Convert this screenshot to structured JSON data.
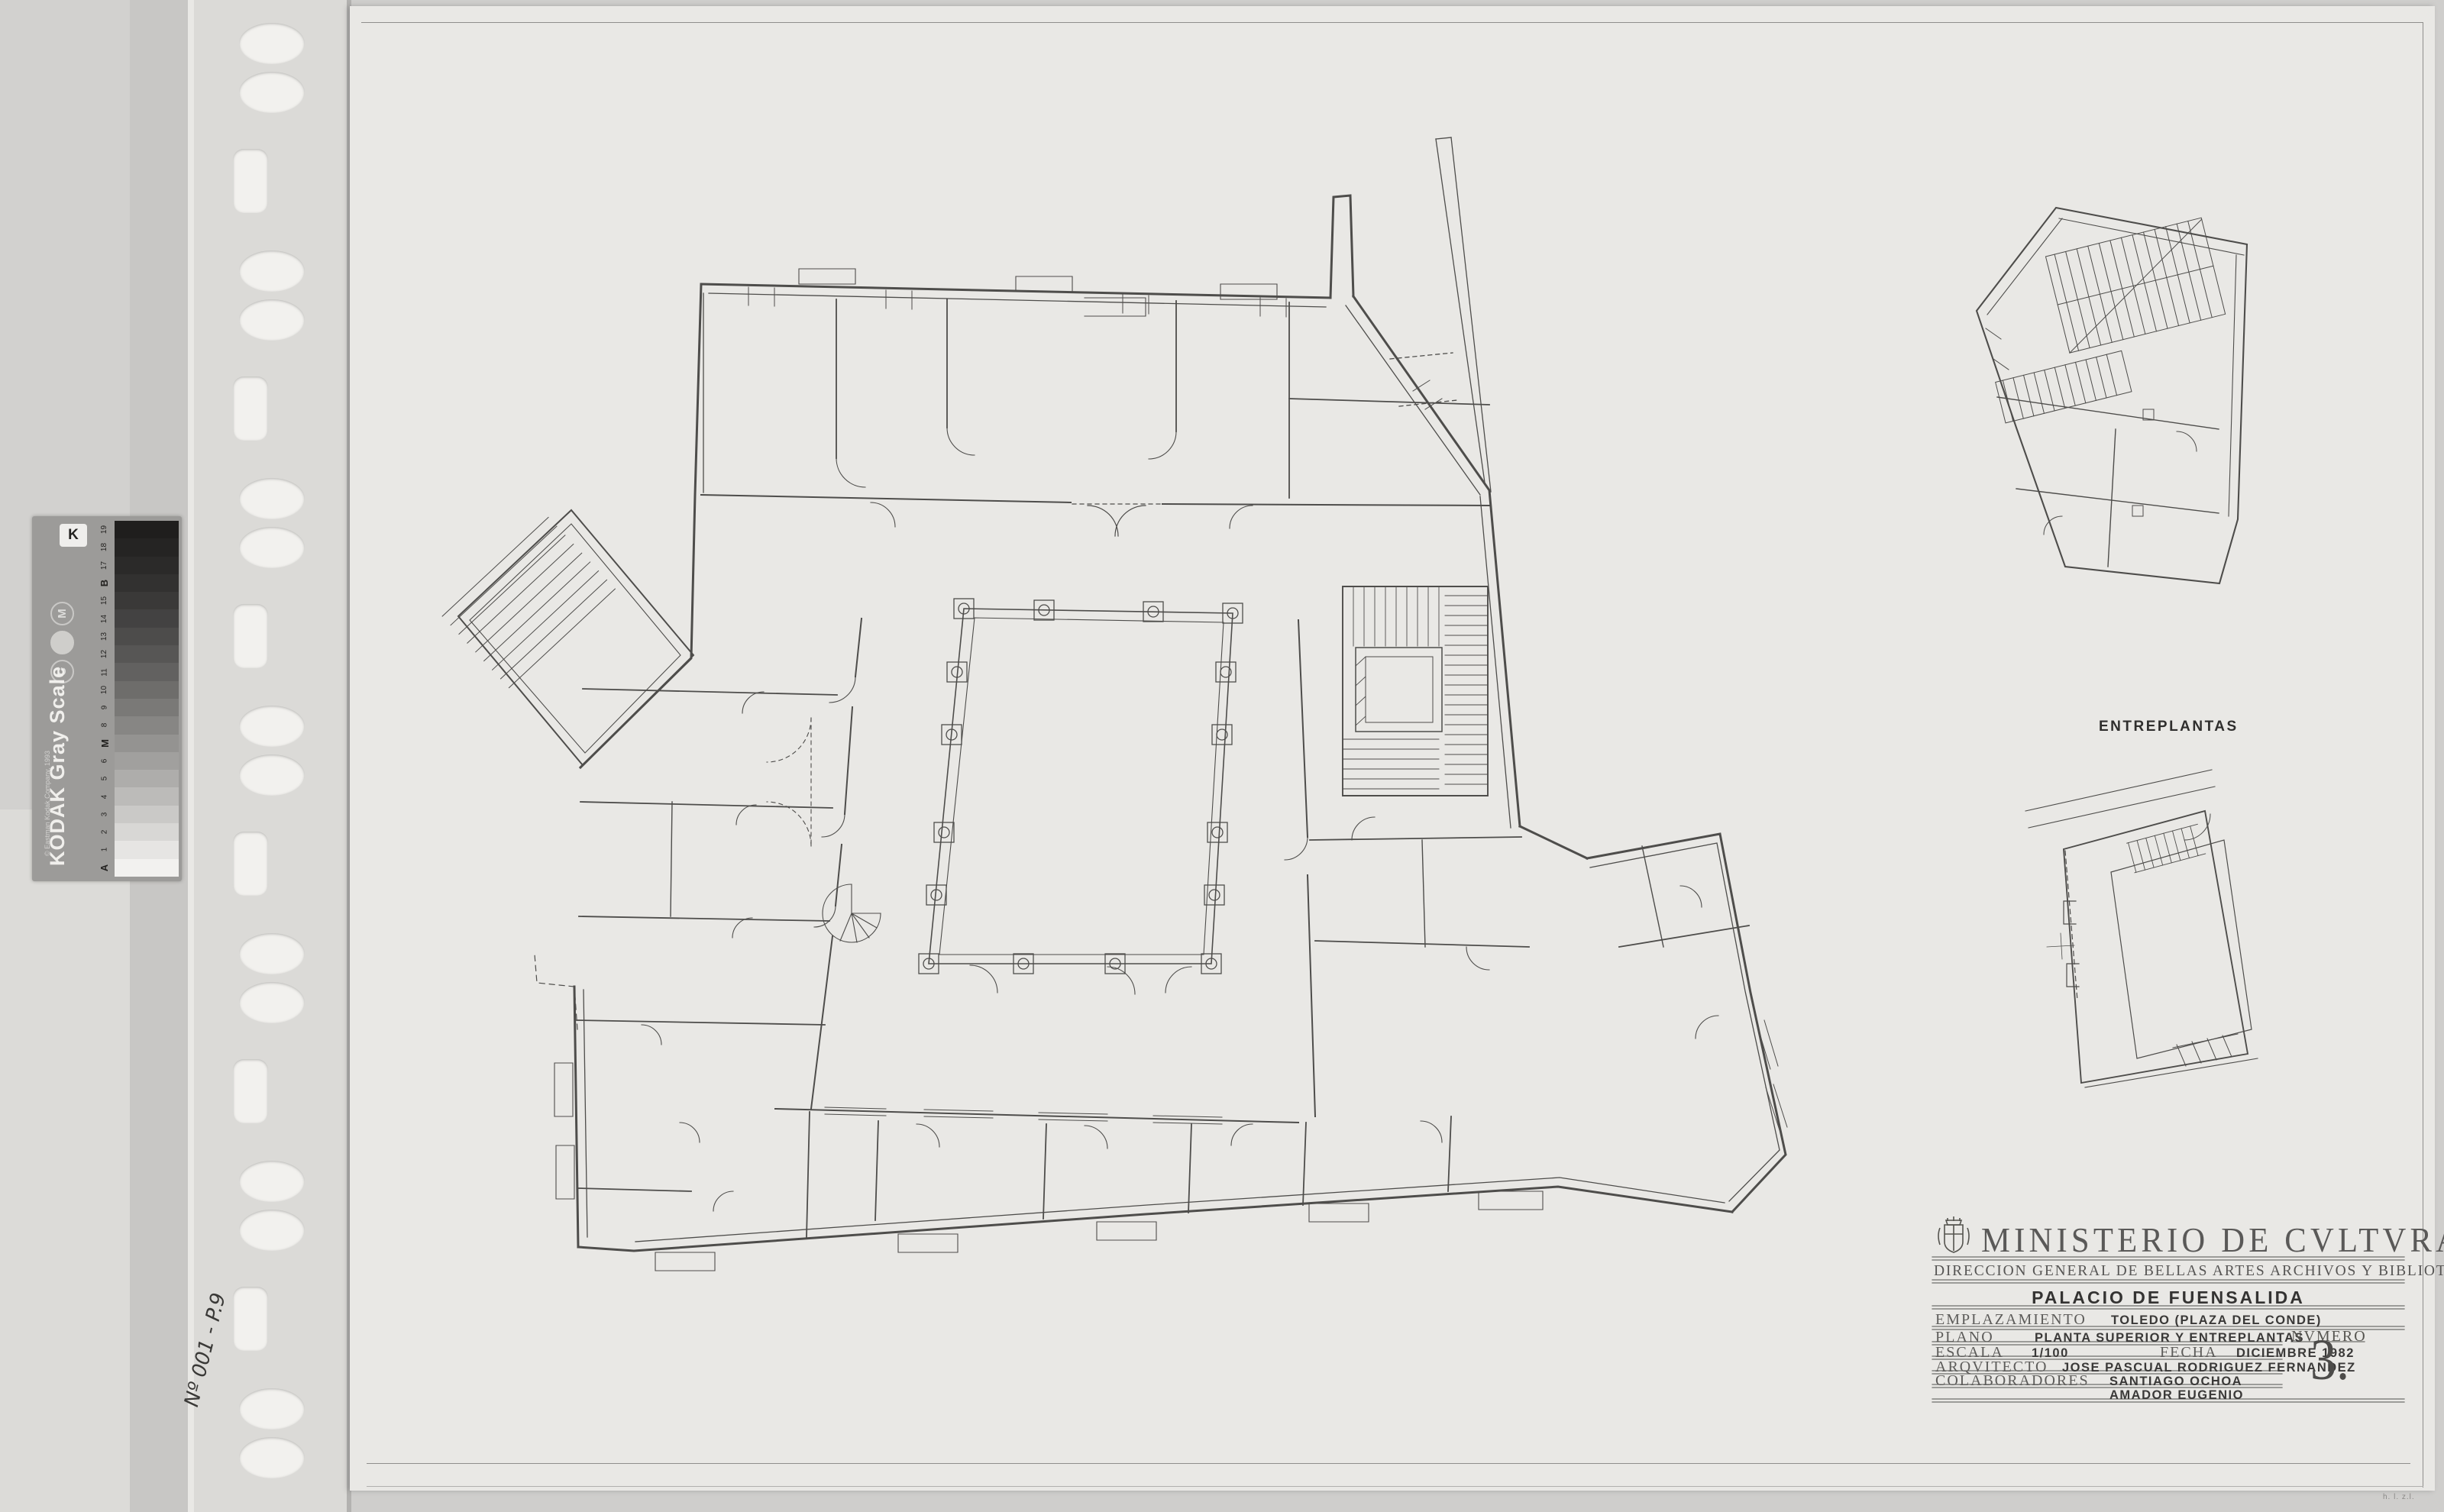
{
  "sheet": {
    "kind": "scanned architectural drawing sheet in punched plastic sleeve"
  },
  "title_block": {
    "ministry": "MINISTERIO DE CVLTVRA",
    "direction": "DIRECCION GENERAL DE BELLAS ARTES ARCHIVOS Y BIBLIOTECAS",
    "project": "PALACIO DE FUENSALIDA",
    "fields": {
      "emplazamiento_label": "EMPLAZAMIENTO",
      "emplazamiento": "TOLEDO (PLAZA DEL CONDE)",
      "plano_label": "PLANO",
      "plano": "PLANTA SUPERIOR Y ENTREPLANTAS",
      "escala_label": "ESCALA",
      "escala": "1/100",
      "fecha_label": "FECHA",
      "fecha": "DICIEMBRE 1982",
      "arquitecto_label": "ARQVITECTO",
      "arquitecto": "JOSE PASCUAL RODRIGUEZ FERNANDEZ",
      "colaboradores_label": "COLABORADORES",
      "colaborador_1": "SANTIAGO OCHOA",
      "colaborador_2": "AMADOR EUGENIO",
      "numero_label": "NVMERO",
      "numero": "3."
    }
  },
  "labels": {
    "entreplantas": "ENTREPLANTAS",
    "handwritten_note": "Nº 001 - P.9",
    "corner_note": "h. l. z.l."
  },
  "kodak_strip": {
    "title": "KODAK Gray Scale",
    "copyright": "© Eastman Kodak Company, 1993",
    "logo_letter": "K",
    "circle_letters": [
      "M",
      "",
      "C"
    ],
    "scale_labels_bottom_to_top": [
      "A",
      "1",
      "2",
      "3",
      "4",
      "5",
      "6",
      "M",
      "8",
      "9",
      "10",
      "11",
      "12",
      "13",
      "14",
      "15",
      "B",
      "17",
      "18",
      "19"
    ],
    "patch_shades_bottom_to_top": [
      "#f2f1ef",
      "#e6e5e3",
      "#d8d7d5",
      "#cac9c7",
      "#bcbbb9",
      "#aeadab",
      "#a1a09e",
      "#949391",
      "#878684",
      "#7a7977",
      "#6e6d6b",
      "#626160",
      "#575655",
      "#4d4c4b",
      "#434242",
      "#3a3938",
      "#323130",
      "#2b2a29",
      "#252423",
      "#1f1e1d"
    ],
    "patch_count": 20
  },
  "colors": {
    "scanner_bg": "#cfcecc",
    "sleeve": "#dbdad7",
    "sheet_paper": "#e9e8e5",
    "plan_line": "#4e4d4b",
    "text_dark": "#343332",
    "text_soft": "#5d5c5a"
  }
}
